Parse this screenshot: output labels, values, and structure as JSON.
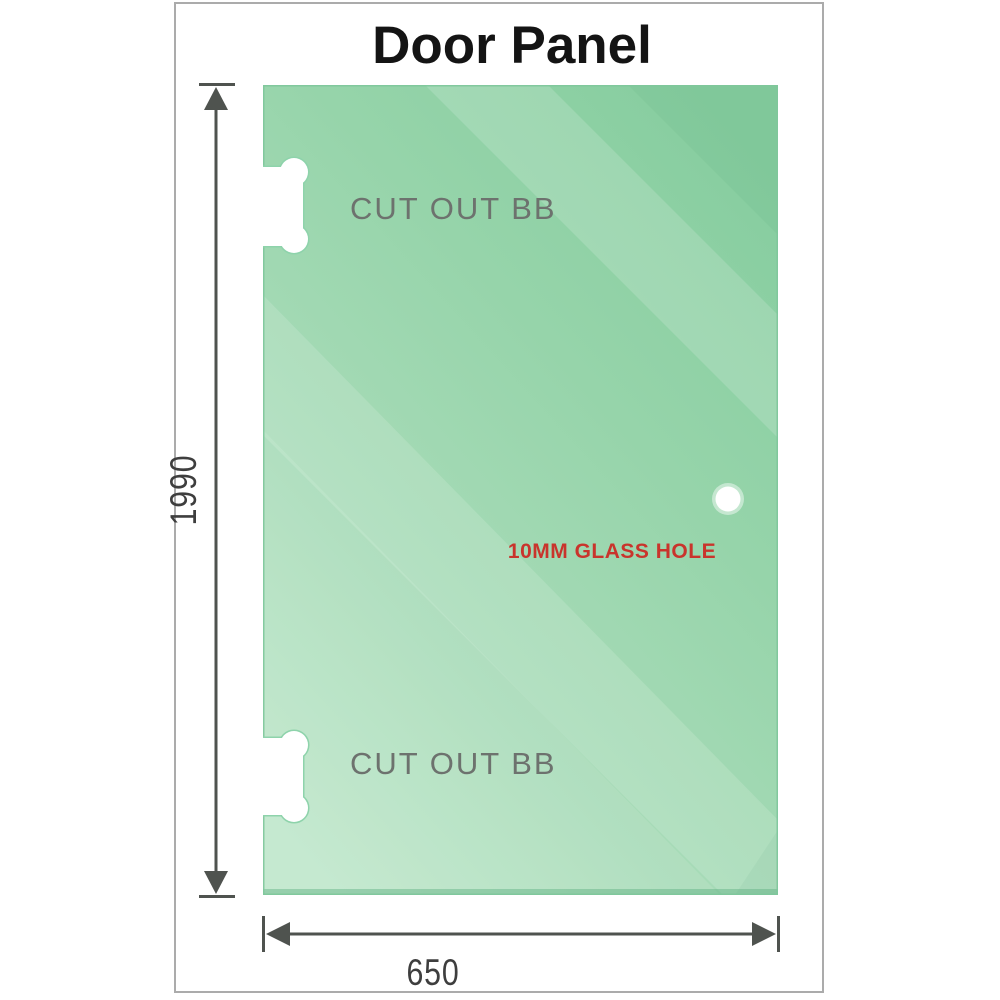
{
  "title": "Door Panel",
  "panel": {
    "type": "glass door panel diagram",
    "cutouts": [
      {
        "label": "CUT OUT BB",
        "position": "top-left edge"
      },
      {
        "label": "CUT OUT BB",
        "position": "bottom-left edge"
      }
    ],
    "hole": {
      "label": "10MM GLASS HOLE"
    }
  },
  "dimensions": {
    "height": "1990",
    "width": "650"
  },
  "colors": {
    "glass_green_dark": "#86cd9f",
    "glass_green_light": "#bfe7cb",
    "dimension_gray": "#4f534f",
    "cutout_label_gray": "#6d726e",
    "hole_label_red": "#c9342c",
    "frame_border_gray": "#ababab",
    "title_black": "#141414"
  },
  "icons": {
    "dimension_arrows": "outward-pointing measurement arrowheads with end ticks"
  }
}
